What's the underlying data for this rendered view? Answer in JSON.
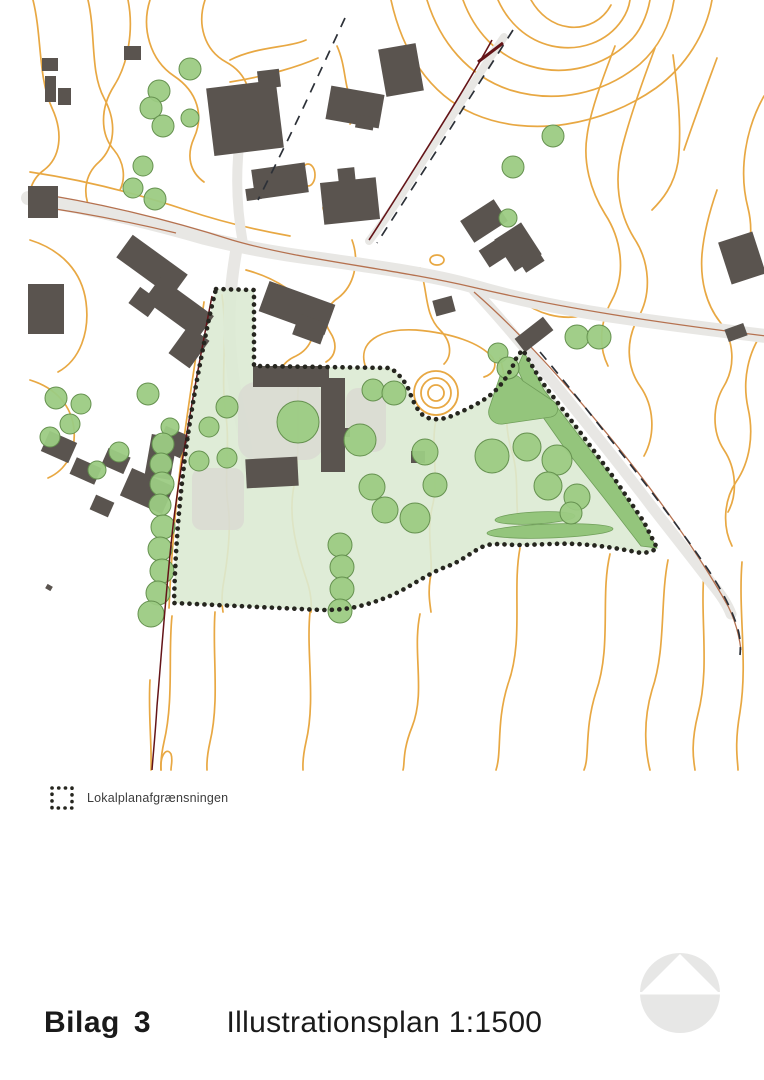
{
  "legend": {
    "label": "Lokalplanafgrænsningen"
  },
  "footer": {
    "label": "Bilag",
    "number": "3",
    "title": "Illustrationsplan 1:1500"
  },
  "map": {
    "colors": {
      "contour": "#e8a843",
      "building": "#5a544f",
      "road_fill": "#e8e7e4",
      "road_line": "#b5714f",
      "cadastre_line": "#641418",
      "dashed_line": "#2d3138",
      "tree_fill": "#9ccb83",
      "tree_stroke": "#65914f",
      "area_fill": "#dcead3",
      "dense_green": "#94c57c",
      "dense_green_stroke": "#6f9e59",
      "paving": "#d8d7d2",
      "boundary_dot": "#26261f",
      "logo_gray": "#e7e7e6"
    },
    "contours": [
      "M33,0 C42,36 38,78 52,108 C64,134 60,158 44,170 C30,180 26,198 32,212",
      "M88,0 C96,34 90,72 104,98 C118,124 114,148 99,162 C84,175 82,196 92,212",
      "M128,0 C134,30 128,64 114,86 C100,108 100,134 114,150 C124,162 126,178 120,190",
      "M150,0 C141,28 150,60 174,76 C198,92 204,116 194,138 C186,156 190,172 204,182",
      "M205,0 C197,24 204,50 226,62 C248,74 254,96 246,116",
      "M230,60 C258,46 288,48 306,40",
      "M230,82 C268,76 300,66 318,58",
      "M337,46 C346,66 344,86 351,98 C357,108 356,118 350,124",
      "M427,0 C440,42 468,76 510,90 C556,104 604,94 640,64 C658,48 670,26 674,0",
      "M463,0 C474,30 496,56 530,66 C566,77 604,66 629,42 C640,32 647,16 650,0",
      "M498,0 C508,22 526,40 552,46 C580,52 607,42 622,20 C626,14 629,7 630,0",
      "M531,0 C539,14 552,25 569,27 C587,29 603,20 611,5",
      "M391,0 C402,50 428,94 474,114 C530,138 602,126 656,88 C686,66 706,34 712,0",
      "M615,46 C602,80 590,112 587,136 C583,162 590,190 605,214 C622,240 626,274 612,300 C600,322 598,346 608,366",
      "M655,48 C643,80 630,116 622,148 C614,180 618,212 634,238 C650,262 652,294 638,318 C626,340 626,366 640,386 C654,406 656,434 644,456",
      "M673,55 C678,92 682,130 678,162 C674,186 662,200 652,210",
      "M717,58 C706,88 694,120 684,150",
      "M717,190 C710,210 704,232 702,254 C700,280 706,304 720,322 C734,340 736,366 724,386 C712,406 712,432 724,450 C736,468 738,494 728,512",
      "M764,96 C746,128 738,170 748,208 C754,232 750,258 736,278",
      "M764,330 C748,352 742,380 748,408 C754,434 750,462 736,482 C724,500 722,526 732,546",
      "M30,172 C84,180 138,194 186,210 C222,222 256,230 290,236",
      "M30,240 C62,250 82,272 86,302 C90,332 80,360 58,372",
      "M30,380 C56,388 72,406 74,430 C76,452 66,470 48,478",
      "M246,270 C276,278 300,294 310,314 C318,330 312,348 296,356 C282,362 276,374 280,386",
      "M352,240 C360,262 354,286 338,298 C326,306 322,320 330,332 C338,344 336,356 326,362",
      "M420,268 C428,290 424,314 440,330 C452,342 452,356 444,364",
      "M366,368 C356,342 380,328 416,330 C452,333 480,343 492,357 C498,365 494,374 484,377",
      "M520,300 C538,314 560,320 582,316",
      "M204,302 C196,358 186,418 180,470 C174,520 171,564 169,608",
      "M222,295 C228,336 220,378 226,416 C230,446 224,478 228,505 C231,527 228,556 224,580 C221,596 222,606 223,612",
      "M300,372 C294,410 302,448 294,486 C288,516 296,548 306,578 C311,592 312,602 311,612",
      "M436,420 C430,448 440,478 432,508 C426,534 434,560 430,580 C428,594 430,604 431,612",
      "M500,358 C510,390 502,422 512,452 C520,478 514,506 520,530",
      "M215,612 C212,652 220,700 210,742 C206,760 207,766 207,770",
      "M310,612 C306,652 316,700 306,742 C302,760 303,766 303,770",
      "M420,614 C412,652 426,692 412,727 C402,752 405,764 403,770",
      "M520,548 C512,590 524,640 508,684 C496,722 502,752 496,770",
      "M610,554 C600,596 612,646 596,692 C584,730 590,756 584,770",
      "M668,560 C660,600 666,650 652,690 C642,724 646,754 650,770",
      "M704,572 C700,620 710,668 698,714 C690,746 694,762 695,770",
      "M742,562 C738,612 748,662 740,712 C734,746 738,762 738,770",
      "M172,616 C168,652 174,700 164,742 C160,760 161,766 161,770",
      "M150,680 C148,712 152,744 151,770",
      "M161,770 C160,754 167,747 171,754 C173,760 171,765 171,770"
    ],
    "contour_ovals": [
      [
        308,
        175,
        7,
        11
      ],
      [
        331,
        208,
        8,
        5
      ],
      [
        437,
        260,
        7,
        5
      ]
    ],
    "roads": [
      {
        "d": "M28,198 C90,208 150,222 205,238 C245,248 280,254 320,259 C370,266 430,274 472,286 C520,300 570,310 620,317 C668,324 716,330 766,336",
        "w": 14
      },
      {
        "d": "M243,244 C238,216 236,186 238,158 C240,130 242,108 241,90",
        "w": 10
      },
      {
        "d": "M236,252 C231,282 228,312 230,342 C232,372 236,402 242,426 C246,446 248,462 247,474",
        "w": 12
      },
      {
        "d": "M504,37 C472,84 434,144 398,200 C386,219 376,232 369,241",
        "w": 8
      },
      {
        "d": "M474,290 C502,320 532,356 562,393 C592,430 624,470 652,507 C670,530 692,558 712,584 C722,596 728,606 731,614",
        "w": 11
      }
    ],
    "road_lines": [
      {
        "d": "M28,192 C96,202 170,220 232,240 C300,260 390,268 472,287 C560,308 660,323 766,336",
        "w": 1.3
      },
      {
        "d": "M28,205 C80,212 130,222 176,233",
        "w": 1.2
      },
      {
        "d": "M474,292 C520,332 572,390 622,452 C660,500 700,556 728,606 C734,618 739,634 741,650",
        "w": 1.3
      }
    ],
    "cadastre_lines": [
      {
        "d": "M492,40 C470,80 446,118 421,158 C406,182 386,214 369,240",
        "w": 1.6
      },
      {
        "d": "M478,62 L503,43",
        "w": 3
      },
      {
        "d": "M212,296 C198,368 184,444 175,510 C168,562 162,648 157,706 C155,738 153,756 152,770",
        "w": 1.5
      }
    ],
    "dashed_lines": [
      "M513,30 C489,68 463,108 437,150 C419,178 397,212 377,243",
      "M540,352 C566,383 596,421 626,459 C655,496 684,534 709,571 C721,589 730,606 736,623 C740,634 741,645 740,655",
      "M345,18 C332,46 318,76 305,104 C290,136 274,168 258,200"
    ],
    "area_boundary": "M216,289 L254,290 L254,366 L390,368 C397,372 404,380 408,388 C412,398 416,410 424,416 C432,421 444,420 456,414 C470,408 484,401 494,392 C504,382 512,370 517,356 L523,350 C530,362 538,377 548,390 L580,432 L614,478 L644,522 L657,548 C652,552 644,554 636,552 C616,548 596,545 576,544 C556,543 536,545 518,545 C504,545 492,542 482,547 C470,553 460,562 448,566 C434,571 420,580 406,588 C392,596 376,602 360,606 C348,609 336,610 322,610 L174,603 C175,560 178,516 183,474 C187,438 193,400 200,364 C205,338 210,312 216,289 Z",
    "paving": [
      {
        "x": 238,
        "y": 382,
        "w": 86,
        "h": 78,
        "rx": 18
      },
      {
        "x": 192,
        "y": 468,
        "w": 52,
        "h": 62,
        "rx": 10
      },
      {
        "x": 346,
        "y": 388,
        "w": 40,
        "h": 64,
        "rx": 12
      }
    ],
    "dense_areas": [
      "M524,352 L544,390 L580,437 L613,479 L643,524 L657,548 L641,546 L604,498 L566,450 L533,403 L517,368 Z",
      "M500,376 C508,371 518,374 523,381 L553,401 C560,406 559,415 551,417 L503,424 C494,425 487,418 489,409 Z"
    ],
    "hedges": [
      [
        535,
        518,
        40,
        6,
        -3
      ],
      [
        550,
        531,
        63,
        7,
        -2
      ]
    ],
    "buildings": [
      [
        42,
        58,
        16,
        13,
        0
      ],
      [
        45,
        76,
        11,
        26,
        0
      ],
      [
        58,
        88,
        13,
        17,
        0
      ],
      [
        124,
        46,
        17,
        14,
        0
      ],
      [
        210,
        84,
        70,
        68,
        -7
      ],
      [
        258,
        70,
        22,
        18,
        -7
      ],
      [
        328,
        90,
        54,
        34,
        10
      ],
      [
        356,
        116,
        18,
        13,
        10
      ],
      [
        382,
        46,
        38,
        48,
        -10
      ],
      [
        28,
        186,
        30,
        32,
        0
      ],
      [
        28,
        284,
        36,
        50,
        0
      ],
      [
        118,
        252,
        68,
        28,
        36
      ],
      [
        146,
        294,
        66,
        28,
        36
      ],
      [
        132,
        292,
        24,
        20,
        36
      ],
      [
        176,
        330,
        26,
        34,
        36
      ],
      [
        253,
        166,
        54,
        30,
        -8
      ],
      [
        246,
        188,
        15,
        12,
        -8
      ],
      [
        322,
        180,
        56,
        42,
        -6
      ],
      [
        338,
        168,
        17,
        14,
        -6
      ],
      [
        434,
        298,
        20,
        16,
        -15
      ],
      [
        262,
        292,
        70,
        32,
        20
      ],
      [
        295,
        318,
        30,
        22,
        20
      ],
      [
        464,
        208,
        40,
        26,
        -33
      ],
      [
        482,
        242,
        26,
        20,
        -33
      ],
      [
        502,
        228,
        32,
        38,
        -33
      ],
      [
        520,
        252,
        22,
        16,
        -33
      ],
      [
        724,
        236,
        36,
        44,
        -18
      ],
      [
        726,
        326,
        20,
        13,
        -20
      ],
      [
        516,
        326,
        36,
        17,
        -38
      ],
      [
        253,
        366,
        76,
        21,
        0
      ],
      [
        321,
        378,
        24,
        94,
        0
      ],
      [
        343,
        428,
        7,
        9,
        0
      ],
      [
        246,
        458,
        52,
        29,
        -3
      ],
      [
        411,
        451,
        14,
        12,
        0
      ],
      [
        44,
        436,
        30,
        22,
        24
      ],
      [
        72,
        462,
        27,
        18,
        24
      ],
      [
        104,
        452,
        24,
        18,
        24
      ],
      [
        124,
        476,
        46,
        30,
        24
      ],
      [
        160,
        430,
        26,
        24,
        24
      ],
      [
        92,
        498,
        20,
        16,
        24
      ],
      [
        148,
        436,
        26,
        42,
        10
      ],
      [
        46,
        585,
        6,
        5,
        30
      ]
    ],
    "trees": [
      [
        190,
        69,
        11
      ],
      [
        159,
        91,
        11
      ],
      [
        151,
        108,
        11
      ],
      [
        163,
        126,
        11
      ],
      [
        190,
        118,
        9
      ],
      [
        143,
        166,
        10
      ],
      [
        133,
        188,
        10
      ],
      [
        155,
        199,
        11
      ],
      [
        553,
        136,
        11
      ],
      [
        513,
        167,
        11
      ],
      [
        508,
        218,
        9
      ],
      [
        577,
        337,
        12
      ],
      [
        599,
        337,
        12
      ],
      [
        148,
        394,
        11
      ],
      [
        56,
        398,
        11
      ],
      [
        81,
        404,
        10
      ],
      [
        70,
        424,
        10
      ],
      [
        50,
        437,
        10
      ],
      [
        119,
        452,
        10
      ],
      [
        97,
        470,
        9
      ],
      [
        170,
        427,
        9
      ],
      [
        163,
        444,
        11
      ],
      [
        161,
        464,
        11
      ],
      [
        162,
        484,
        12
      ],
      [
        160,
        505,
        11
      ],
      [
        163,
        527,
        12
      ],
      [
        160,
        549,
        12
      ],
      [
        162,
        571,
        12
      ],
      [
        158,
        593,
        12
      ],
      [
        151,
        614,
        13
      ],
      [
        227,
        407,
        11
      ],
      [
        209,
        427,
        10
      ],
      [
        199,
        461,
        10
      ],
      [
        227,
        458,
        10
      ],
      [
        298,
        422,
        21
      ],
      [
        373,
        390,
        11
      ],
      [
        394,
        393,
        12
      ],
      [
        360,
        440,
        16
      ],
      [
        425,
        452,
        13
      ],
      [
        435,
        485,
        12
      ],
      [
        340,
        545,
        12
      ],
      [
        342,
        567,
        12
      ],
      [
        342,
        589,
        12
      ],
      [
        340,
        611,
        12
      ],
      [
        372,
        487,
        13
      ],
      [
        385,
        510,
        13
      ],
      [
        415,
        518,
        15
      ],
      [
        492,
        456,
        17
      ],
      [
        527,
        447,
        14
      ],
      [
        557,
        460,
        15
      ],
      [
        548,
        486,
        14
      ],
      [
        577,
        497,
        13
      ],
      [
        571,
        513,
        11
      ],
      [
        498,
        353,
        10
      ],
      [
        508,
        368,
        11
      ]
    ],
    "mound": {
      "cx": 436,
      "cy": 393,
      "radii": [
        8,
        15,
        22
      ]
    }
  }
}
